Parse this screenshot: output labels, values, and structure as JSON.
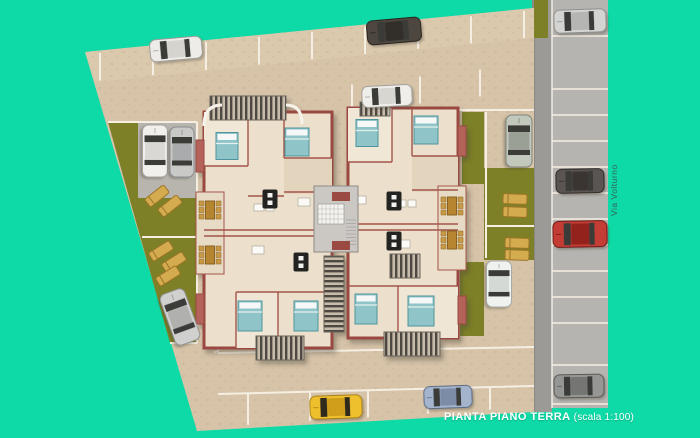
{
  "title": {
    "main": "PIANTA PIANO TERRA",
    "scale": "(scala 1:100)"
  },
  "road_label": "Via Volturno",
  "palette": {
    "background": "#0edaa7",
    "pavement": "#d6c3a8",
    "pavement_light": "#dbc9ae",
    "line": "#f5efe3",
    "grass": "#7d8026",
    "road": "#9c9a96",
    "road_bay": "#b6b4b0",
    "wall": "#9a4a42",
    "wall_accent": "#b4635a",
    "floor": "#ecdfcb",
    "bed": "#8fc5c9",
    "bed_stroke": "#4f949c",
    "lounger": "#d4ab4f",
    "lounger_stroke": "#9b7427",
    "stripe": "#4d4a43",
    "stair": "#cbc8c4",
    "table_dark": "#232321",
    "table_brown": "#b5852f",
    "chair_brown": "#c99a45"
  },
  "cars": [
    {
      "id": "white-top-left-bay",
      "cx": 176,
      "cy": 49,
      "len": 52,
      "wid": 22,
      "rot": -5,
      "body": "#edece8",
      "roof": "#d6d4cf",
      "shade": "#9e9c97"
    },
    {
      "id": "dark-gray-top-bay",
      "cx": 394,
      "cy": 31,
      "len": 54,
      "wid": 24,
      "rot": -5,
      "body": "#4e463f",
      "roof": "#332e29",
      "shade": "#26221e"
    },
    {
      "id": "white-second-row",
      "cx": 387,
      "cy": 96,
      "len": 50,
      "wid": 21,
      "rot": -3,
      "body": "#f0eeea",
      "roof": "#d8d6d1",
      "shade": "#a3a19c"
    },
    {
      "id": "white-left-garden",
      "cx": 155,
      "cy": 151,
      "len": 52,
      "wid": 25,
      "rot": 90,
      "body": "#f1f0ed",
      "roof": "#d9d8d4",
      "shade": "#a5a4a0"
    },
    {
      "id": "silver-left-garden",
      "cx": 182,
      "cy": 152,
      "len": 50,
      "wid": 24,
      "rot": 90,
      "body": "#c9c9c8",
      "roof": "#a9abac",
      "shade": "#8b8d8e"
    },
    {
      "id": "silver-green-right-top",
      "cx": 519,
      "cy": 141,
      "len": 52,
      "wid": 26,
      "rot": 90,
      "body": "#c2c8bc",
      "roof": "#9aa096",
      "shade": "#7f857b"
    },
    {
      "id": "white-right-lower",
      "cx": 499,
      "cy": 284,
      "len": 46,
      "wid": 25,
      "rot": 90,
      "body": "#f0f2f0",
      "roof": "#d5d9d5",
      "shade": "#a7aba7"
    },
    {
      "id": "silver-bottom-left-diagonal",
      "cx": 180,
      "cy": 317,
      "len": 54,
      "wid": 26,
      "rot": 70,
      "body": "#d0d0ce",
      "roof": "#b0b0ae",
      "shade": "#8f8f8d"
    },
    {
      "id": "yellow-bottom-bay",
      "cx": 336,
      "cy": 407,
      "len": 52,
      "wid": 23,
      "rot": -2,
      "body": "#eec02e",
      "roof": "#d19e1a",
      "shade": "#a87f13",
      "glass": "#2e2a1e"
    },
    {
      "id": "blue-bottom-bay",
      "cx": 448,
      "cy": 397,
      "len": 48,
      "wid": 22,
      "rot": -2,
      "body": "#a3b4cc",
      "roof": "#7c8ca6",
      "shade": "#5d6b82"
    },
    {
      "id": "gray-road-top",
      "cx": 580,
      "cy": 21,
      "len": 52,
      "wid": 23,
      "rot": -2,
      "body": "#d4d4d2",
      "roof": "#b5b5b3",
      "shade": "#8f8f8d"
    },
    {
      "id": "dark-gray-road",
      "cx": 580,
      "cy": 181,
      "len": 48,
      "wid": 24,
      "rot": -1,
      "body": "#5a5552",
      "roof": "#3a3633",
      "shade": "#2a2724"
    },
    {
      "id": "red-road",
      "cx": 580,
      "cy": 234,
      "len": 54,
      "wid": 26,
      "rot": -1,
      "body": "#c33e36",
      "roof": "#93201c",
      "shade": "#6e1714"
    },
    {
      "id": "gray-road-bottom",
      "cx": 579,
      "cy": 386,
      "len": 50,
      "wid": 23,
      "rot": -1,
      "body": "#969694",
      "roof": "#757573",
      "shade": "#565654"
    }
  ],
  "beds": [
    {
      "cx": 227,
      "cy": 146,
      "w": 22,
      "h": 27
    },
    {
      "cx": 297,
      "cy": 142,
      "w": 24,
      "h": 28
    },
    {
      "cx": 250,
      "cy": 316,
      "w": 24,
      "h": 30
    },
    {
      "cx": 306,
      "cy": 316,
      "w": 24,
      "h": 30
    },
    {
      "cx": 367,
      "cy": 133,
      "w": 22,
      "h": 27
    },
    {
      "cx": 426,
      "cy": 130,
      "w": 24,
      "h": 28
    },
    {
      "cx": 366,
      "cy": 309,
      "w": 22,
      "h": 30
    },
    {
      "cx": 421,
      "cy": 311,
      "w": 26,
      "h": 30
    }
  ],
  "loungers": [
    {
      "cx": 157,
      "cy": 196,
      "rot": -38
    },
    {
      "cx": 170,
      "cy": 206,
      "rot": -38
    },
    {
      "cx": 161,
      "cy": 251,
      "rot": -32
    },
    {
      "cx": 174,
      "cy": 262,
      "rot": -32
    },
    {
      "cx": 168,
      "cy": 276,
      "rot": -32
    },
    {
      "cx": 515,
      "cy": 199,
      "rot": 2
    },
    {
      "cx": 515,
      "cy": 212,
      "rot": 2
    },
    {
      "cx": 517,
      "cy": 243,
      "rot": 2
    },
    {
      "cx": 517,
      "cy": 255,
      "rot": 2
    }
  ],
  "tables_dark": [
    {
      "cx": 270,
      "cy": 199
    },
    {
      "cx": 301,
      "cy": 262
    },
    {
      "cx": 394,
      "cy": 201
    },
    {
      "cx": 394,
      "cy": 241
    }
  ],
  "tables_brown": [
    {
      "cx": 210,
      "cy": 210
    },
    {
      "cx": 210,
      "cy": 255
    },
    {
      "cx": 452,
      "cy": 206
    },
    {
      "cx": 452,
      "cy": 240
    }
  ]
}
